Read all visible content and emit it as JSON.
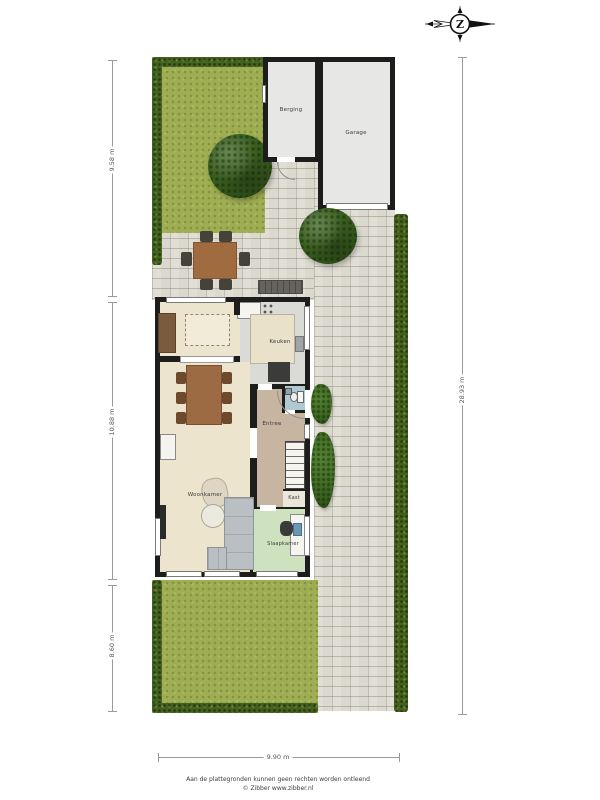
{
  "compass": {
    "letter": "Z"
  },
  "plan": {
    "rooms": {
      "berging": "Berging",
      "garage": "Garage",
      "keuken": "Keuken",
      "woonkamer": "Woonkamer",
      "entree": "Entree",
      "kast": "Kast",
      "slaapkamer": "Slaapkamer"
    },
    "dimensions": {
      "left_top": "9.58 m",
      "left_middle": "10.88 m",
      "left_bottom": "8.60 m",
      "right": "28.93 m",
      "bottom": "9.90 m"
    },
    "colors": {
      "grass": "#9fae52",
      "hedge": "#45611f",
      "paving": "#dbd8ce",
      "wall": "#1d1d1b",
      "floor_living": "#ece4cd",
      "floor_kitchen": "#dadad6",
      "floor_hall": "#c7b5a1",
      "floor_bedroom": "#cfe2c0",
      "floor_toilet": "#aec9d4",
      "floor_shed": "#e7e7e5"
    }
  },
  "footer": {
    "disclaimer": "Aan de plattegronden kunnen geen rechten worden ontleend",
    "credit": "© Zibber www.zibber.nl"
  }
}
